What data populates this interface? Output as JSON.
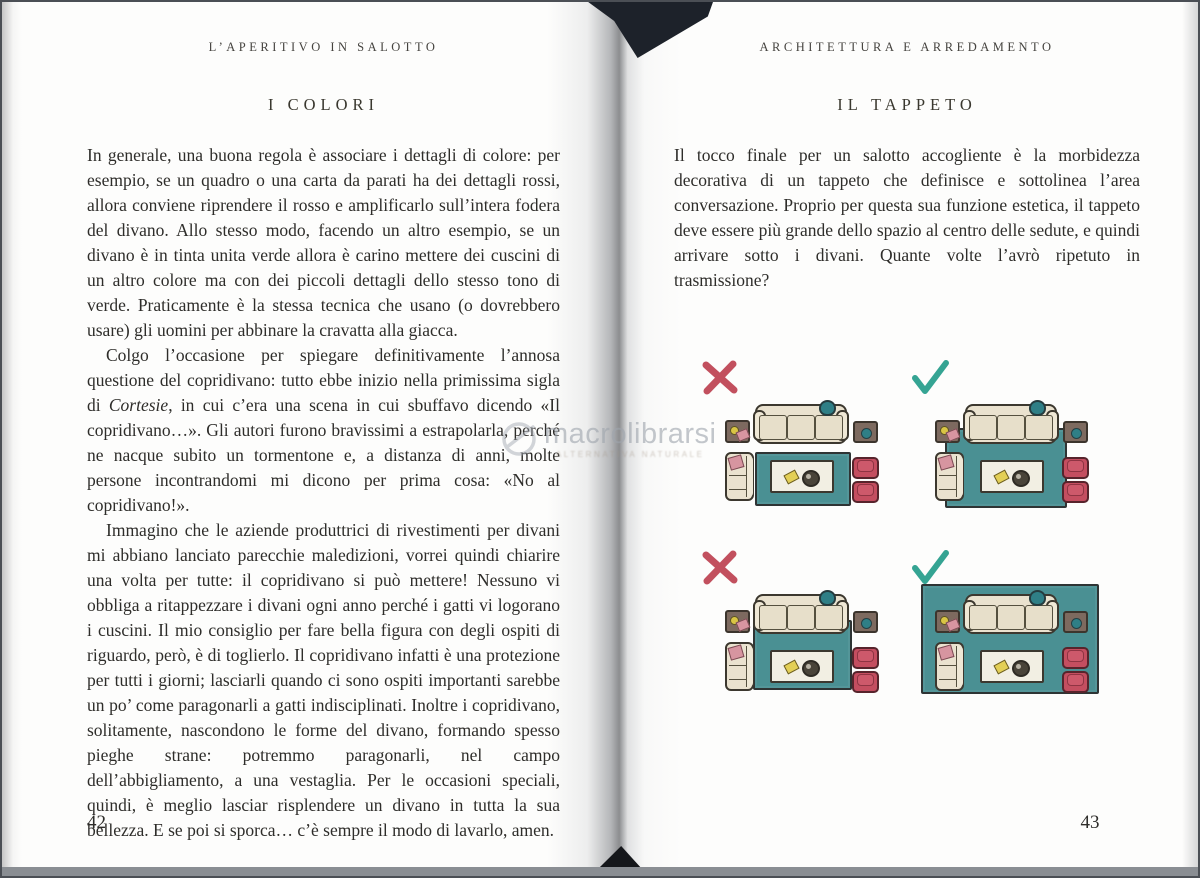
{
  "book": {
    "left_page": {
      "header": "L’APERITIVO IN SALOTTO",
      "title": "I COLORI",
      "page_number": "42",
      "paragraph1": "In generale, una buona regola è associare i dettagli di colore: per esempio, se un quadro o una carta da parati ha dei dettagli rossi, allora conviene riprendere il rosso e amplificarlo sull’intera fodera del divano. Allo stesso modo, facendo un altro esempio, se un divano è in tinta unita verde allora è carino mettere dei cuscini di un altro colore ma con dei piccoli dettagli dello stesso tono di verde. Praticamente è la stessa tecnica che usano (o dovrebbero usare) gli uomini per abbinare la cravatta alla giacca.",
      "paragraph2_pre": "Colgo l’occasione per spiegare definitivamente l’annosa questione del copridivano: tutto ebbe inizio nella primissima sigla di ",
      "paragraph2_italic": "Cortesie",
      "paragraph2_post": ", in cui c’era una scena in cui sbuffavo dicendo «Il copridivano…». Gli autori furono bravissimi a estrapolarla, perché ne nacque subito un tormentone e, a distanza di anni, molte persone incontrandomi mi dicono per prima cosa: «No al copridivano!».",
      "paragraph3": "Immagino che le aziende produttrici di rivestimenti per divani mi abbiano lanciato parecchie maledizioni, vorrei quindi chiarire una volta per tutte: il copridivano si può mettere! Nessuno vi obbliga a ritappezzare i divani ogni anno perché i gatti vi logorano i cuscini. Il mio consiglio per fare bella figura con degli ospiti di riguardo, però, è di toglierlo. Il copridivano infatti è una protezione per tutti i giorni; lasciarli quando ci sono ospiti importanti sarebbe un po’ come paragonarli a gatti indisciplinati. Inoltre i copridivano, solitamente, nascondono le forme del divano, formando spesso pieghe strane: potremmo paragonarli, nel campo dell’abbigliamento, a una vestaglia. Per le occasioni speciali, quindi, è meglio lasciar risplendere un divano in tutta la sua bellezza. E se poi si sporca… c’è sempre il modo di lavarlo, amen."
    },
    "right_page": {
      "header": "ARCHITETTURA E ARREDAMENTO",
      "title": "IL TAPPETO",
      "page_number": "43",
      "paragraph1": "Il tocco finale per un salotto accogliente è la morbidezza decorativa di un tappeto che definisce e sottolinea l’area conversazione. Proprio per questa sua funzione estetica, il tappeto deve essere più grande dello spazio al centro delle sedute, e quindi arrivare sotto i divani. Quante volte l’avrò ripetuto in trasmissione?"
    },
    "watermark": {
      "text": "macrolibrarsi",
      "tagline": "ALTERNATIVA NATURALE"
    },
    "diagrams": {
      "items": [
        {
          "position": "top-left",
          "mark": "x-icon",
          "verdict": "wrong",
          "rug": "small rug, clear of all furniture"
        },
        {
          "position": "top-right",
          "mark": "check-icon",
          "verdict": "right",
          "rug": "larger rug reaching under sofa and chairs"
        },
        {
          "position": "bottom-left",
          "mark": "x-icon",
          "verdict": "wrong",
          "rug": "rug touching sofa only, chairs off"
        },
        {
          "position": "bottom-right",
          "mark": "check-icon",
          "verdict": "right",
          "rug": "large rug under all furniture"
        }
      ],
      "colors": {
        "x_mark": "#c2505e",
        "check_mark": "#35a493",
        "rug": "#4a9093",
        "sofa": "#eae2cf",
        "armchair_red": "#c44e60",
        "side_table_brown": "#7d6a5f"
      }
    }
  }
}
